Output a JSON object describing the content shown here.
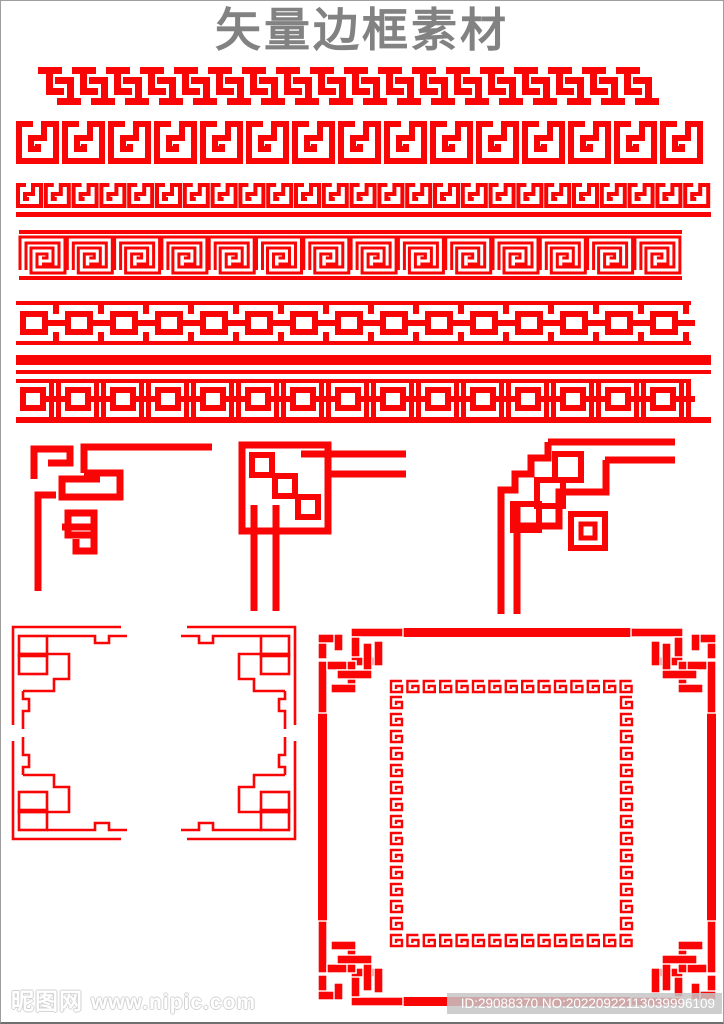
{
  "page": {
    "title": "矢量边框素材",
    "background": "#ffffff",
    "frame_border_color": "#9e9e9e"
  },
  "colors": {
    "red": "#fa0505",
    "title_gray": "#828282",
    "watermark_outline": "#d2d2d2",
    "id_bar_bg": "#c6c6c6",
    "id_text": "#ffffff"
  },
  "watermark": {
    "site_name": "昵图网",
    "site_url": "www.nipic.com"
  },
  "id_badge": {
    "text": "ID:29088370 NO:20220922113039996109"
  },
  "assets": {
    "border_rows": [
      {
        "name": "interlocking-t-border",
        "repeats": 18
      },
      {
        "name": "spiral-meander-border-large",
        "repeats": 15
      },
      {
        "name": "spiral-meander-border-small-with-baseline",
        "repeats": 25
      },
      {
        "name": "outlined-meander-border-with-rails",
        "repeats": 14
      },
      {
        "name": "square-chain-border",
        "repeats": 15
      },
      {
        "name": "square-chain-border-with-bars",
        "repeats": 15
      }
    ],
    "corner_ornaments": [
      {
        "name": "corner-ornament-hooked"
      },
      {
        "name": "corner-ornament-squares-diagonal"
      },
      {
        "name": "corner-ornament-stairstep"
      }
    ],
    "frames": [
      {
        "name": "thin-line-frame-ornate-corners"
      },
      {
        "name": "thick-knot-frame-with-inner-meander"
      }
    ]
  }
}
